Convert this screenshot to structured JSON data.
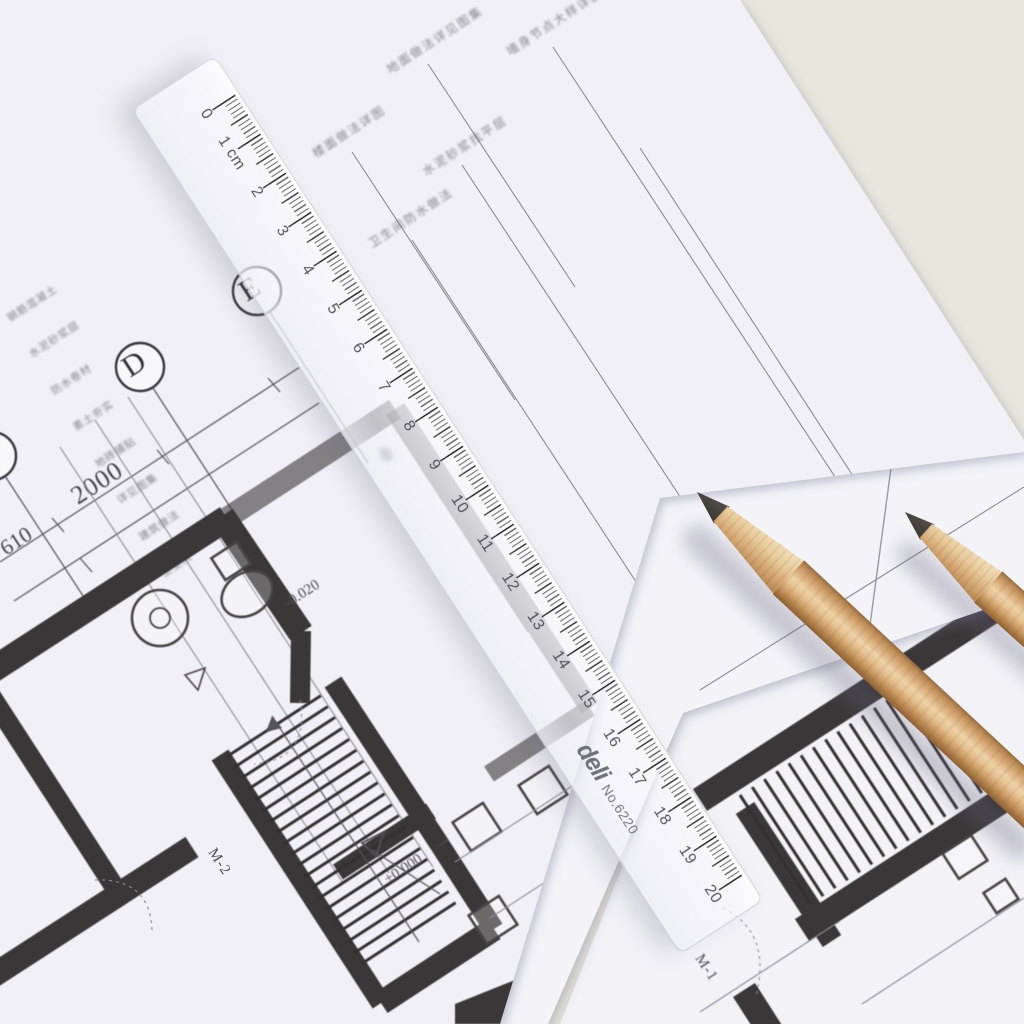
{
  "ruler": {
    "marks": [
      "0",
      "1 cm",
      "2",
      "3",
      "4",
      "5",
      "6",
      "7",
      "8",
      "9",
      "10",
      "11",
      "12",
      "13",
      "14",
      "15",
      "16",
      "17",
      "18",
      "19",
      "20"
    ],
    "brand": "deli",
    "model": "No.6220"
  },
  "blueprint": {
    "grid_labels": {
      "d": "D",
      "e": "E"
    },
    "dimensions": {
      "dim1": "2000",
      "dim2": "610"
    },
    "levels": {
      "zero": "±0.000",
      "bath": "-0.020"
    },
    "door_codes": {
      "m2": "M-2",
      "m1": "M-1"
    },
    "callouts": [
      "楼面做法详图",
      "卫生间防水做法",
      "水泥砂浆找平层",
      "地面做法详见图集",
      "墙身节点大样详图",
      "商店"
    ],
    "notes": [
      "钢筋混凝土",
      "水泥砂浆层",
      "防水卷材",
      "素土夯实",
      "地砖铺贴",
      "详见图集",
      "建筑做法",
      "卫生间"
    ]
  },
  "colors": {
    "desk": "#e9e6dd",
    "paper": "#f1f0f6",
    "ink": "#3b3738",
    "fine_line": "#8b8b94",
    "pencil_wood": "#d9ab79",
    "graphite": "#3a3835",
    "ruler_tint": "#f5f5fa"
  }
}
